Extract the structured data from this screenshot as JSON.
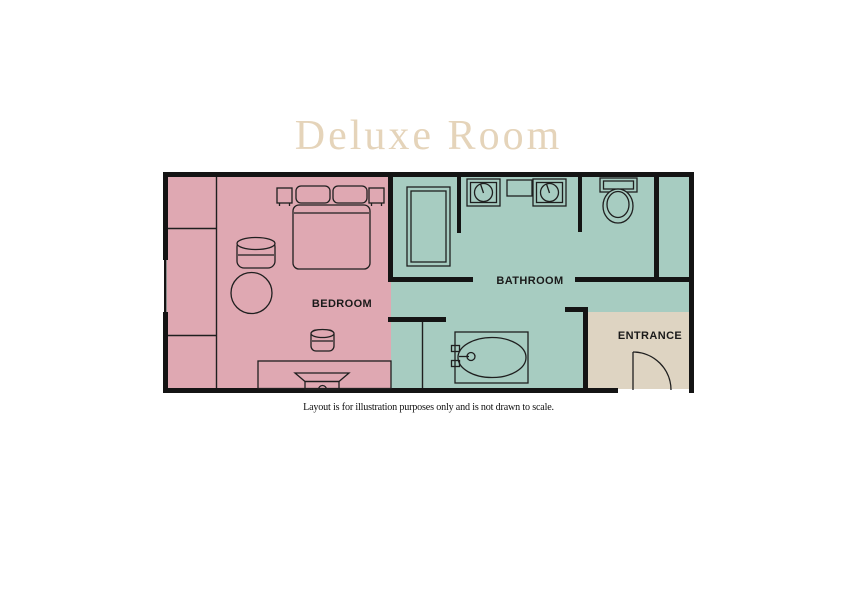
{
  "title": "Deluxe Room",
  "caption": "Layout is for illustration purposes only and is not drawn to scale.",
  "rooms": {
    "bedroom": {
      "label": "BEDROOM"
    },
    "bathroom": {
      "label": "BATHROOM"
    },
    "entrance": {
      "label": "ENTRANCE"
    }
  },
  "fixtures": [
    "double-bed",
    "pillows",
    "nightstands",
    "barrel-chair",
    "round-table",
    "stool",
    "desk",
    "tv",
    "wardrobe",
    "shower",
    "twin-sinks",
    "vanity-shelf",
    "toilet",
    "bathtub",
    "entrance-door"
  ],
  "colors": {
    "bedroom": "#dfa8b2",
    "bathroom": "#a7ccc1",
    "entrance": "#ded4c2",
    "title": "#e5d4ba",
    "wall": "#141414",
    "line": "#1f1f1f",
    "label": "#1a1a1a"
  }
}
